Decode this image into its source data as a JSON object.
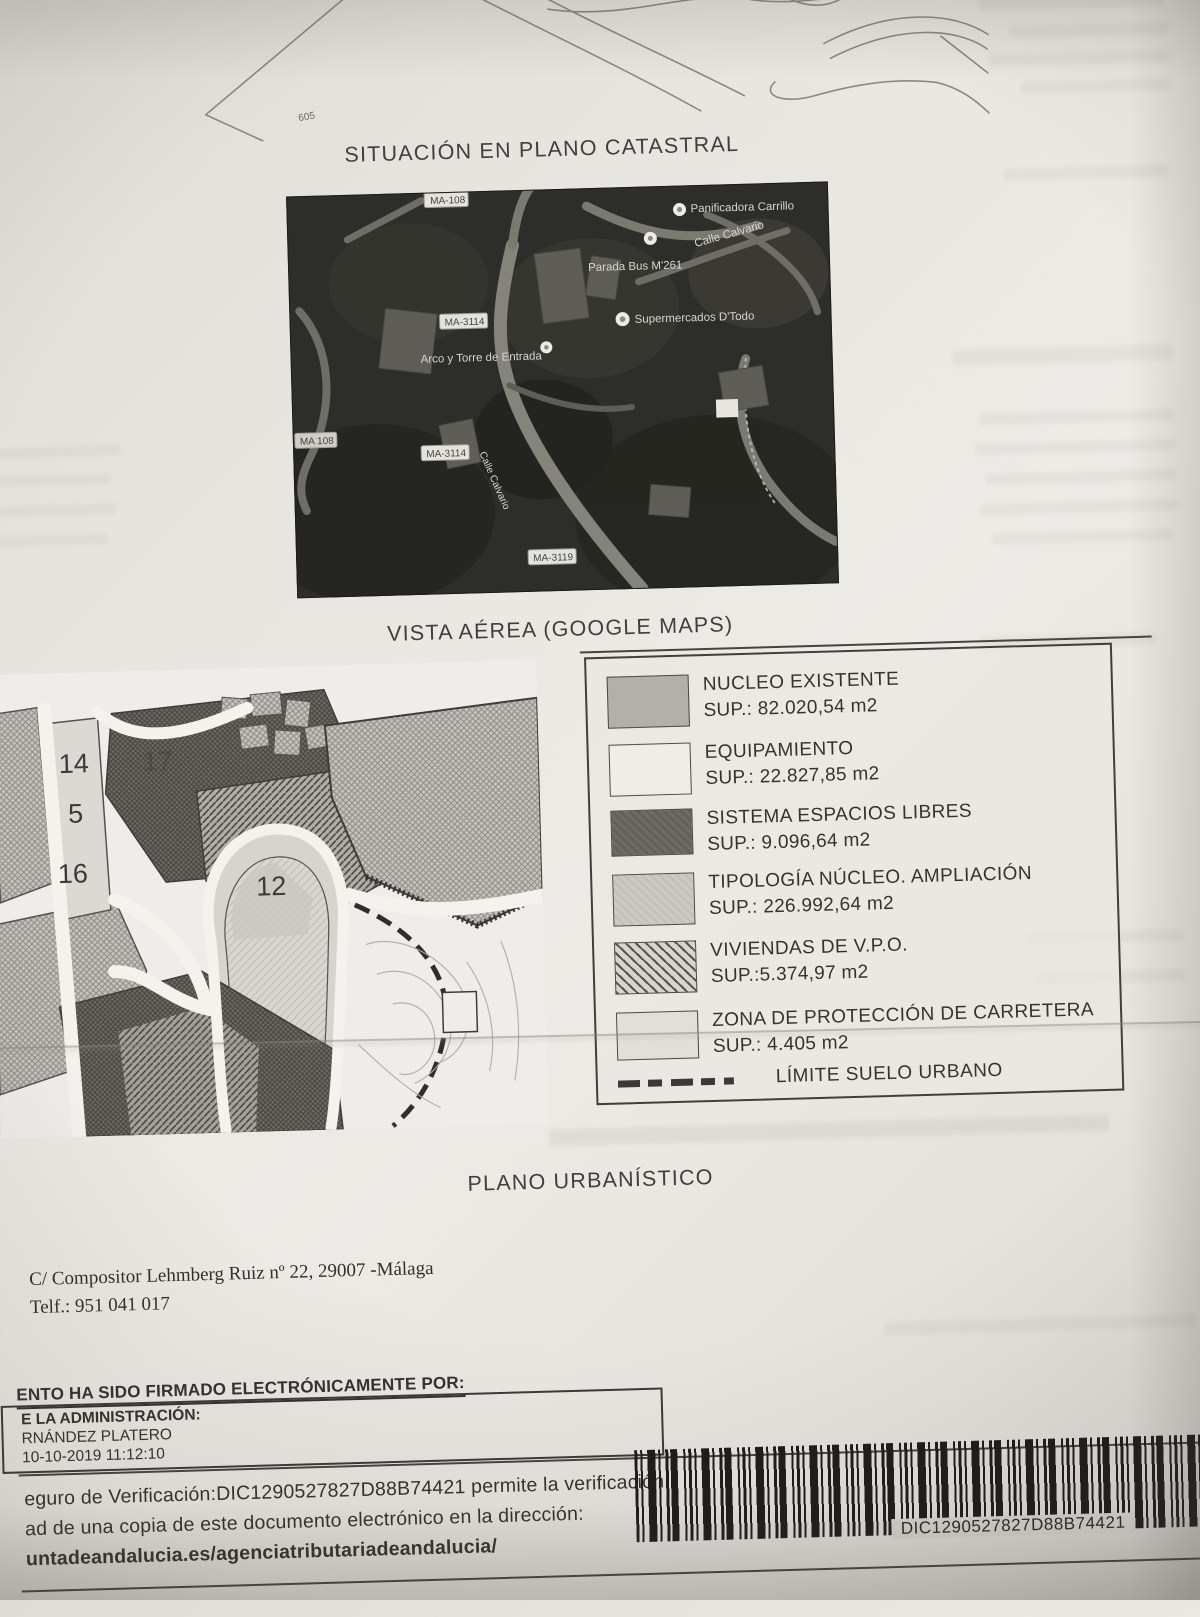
{
  "page": {
    "title_catastral": "SITUACIÓN EN PLANO CATASTRAL",
    "caption_aerial": "VISTA AÉREA (GOOGLE MAPS)",
    "caption_plano": "PLANO URBANÍSTICO"
  },
  "top_drawing": {
    "label": "605"
  },
  "aerial": {
    "labels": {
      "panificadora": "Panificadora Carrillo",
      "parada_bus": "Parada Bus M'261",
      "calle_calvario_top": "Calle Calvario",
      "supermercados": "Supermercados D'Todo",
      "arco_torre": "Arco y Torre de Entrada",
      "calle_calvario_side": "Calle Calvario"
    },
    "road_badges": [
      "MA-108",
      "MA-3114",
      "MA 108",
      "MA-3114",
      "MA-3119"
    ]
  },
  "urban_map": {
    "zone_numbers": [
      "14",
      "17",
      "5",
      "16",
      "12"
    ]
  },
  "legend": {
    "items": [
      {
        "name": "NUCLEO  EXISTENTE",
        "sup": "SUP.: 82.020,54 m2",
        "swatch": "solid-medium-gray"
      },
      {
        "name": "EQUIPAMIENTO",
        "sup": "SUP.: 22.827,85 m2",
        "swatch": "near-white"
      },
      {
        "name": "SISTEMA ESPACIOS LIBRES",
        "sup": "SUP.: 9.096,64 m2",
        "swatch": "dark-gray"
      },
      {
        "name": "TIPOLOGÍA NÚCLEO. AMPLIACIÓN",
        "sup": "SUP.: 226.992,64 m2",
        "swatch": "light-gray"
      },
      {
        "name": "VIVIENDAS DE V.P.O.",
        "sup": "SUP.:5.374,97 m2",
        "swatch": "diagonal-hatch"
      },
      {
        "name": "ZONA DE PROTECCIÓN DE CARRETERA",
        "sup": "SUP.: 4.405 m2",
        "swatch": "pale-gray"
      }
    ],
    "limite_label": "LÍMITE SUELO URBANO"
  },
  "footer": {
    "address_line1": "C/ Compositor  Lehmberg Ruiz nº 22, 29007 -Málaga",
    "address_line2": "Telf.: 951 041 017"
  },
  "signature_box": {
    "heading": "ENTO HA SIDO FIRMADO ELECTRÓNICAMENTE POR:",
    "line1": "E LA ADMINISTRACIÓN:",
    "line2": "RNÁNDEZ PLATERO",
    "line3": "10-10-2019 11:12:10"
  },
  "verification": {
    "line1": "eguro de Verificación:DIC1290527827D88B74421 permite la verificación",
    "line2": "ad de una copia de este documento electrónico en la dirección:",
    "line3": "untadeandalucia.es/agenciatributariadeandalucia/"
  },
  "barcode": {
    "text": "DIC1290527827D88B74421"
  },
  "colors": {
    "paper": "#e9e6e1",
    "ink": "#3a3936",
    "aerial_bg": "#2d2d29"
  }
}
